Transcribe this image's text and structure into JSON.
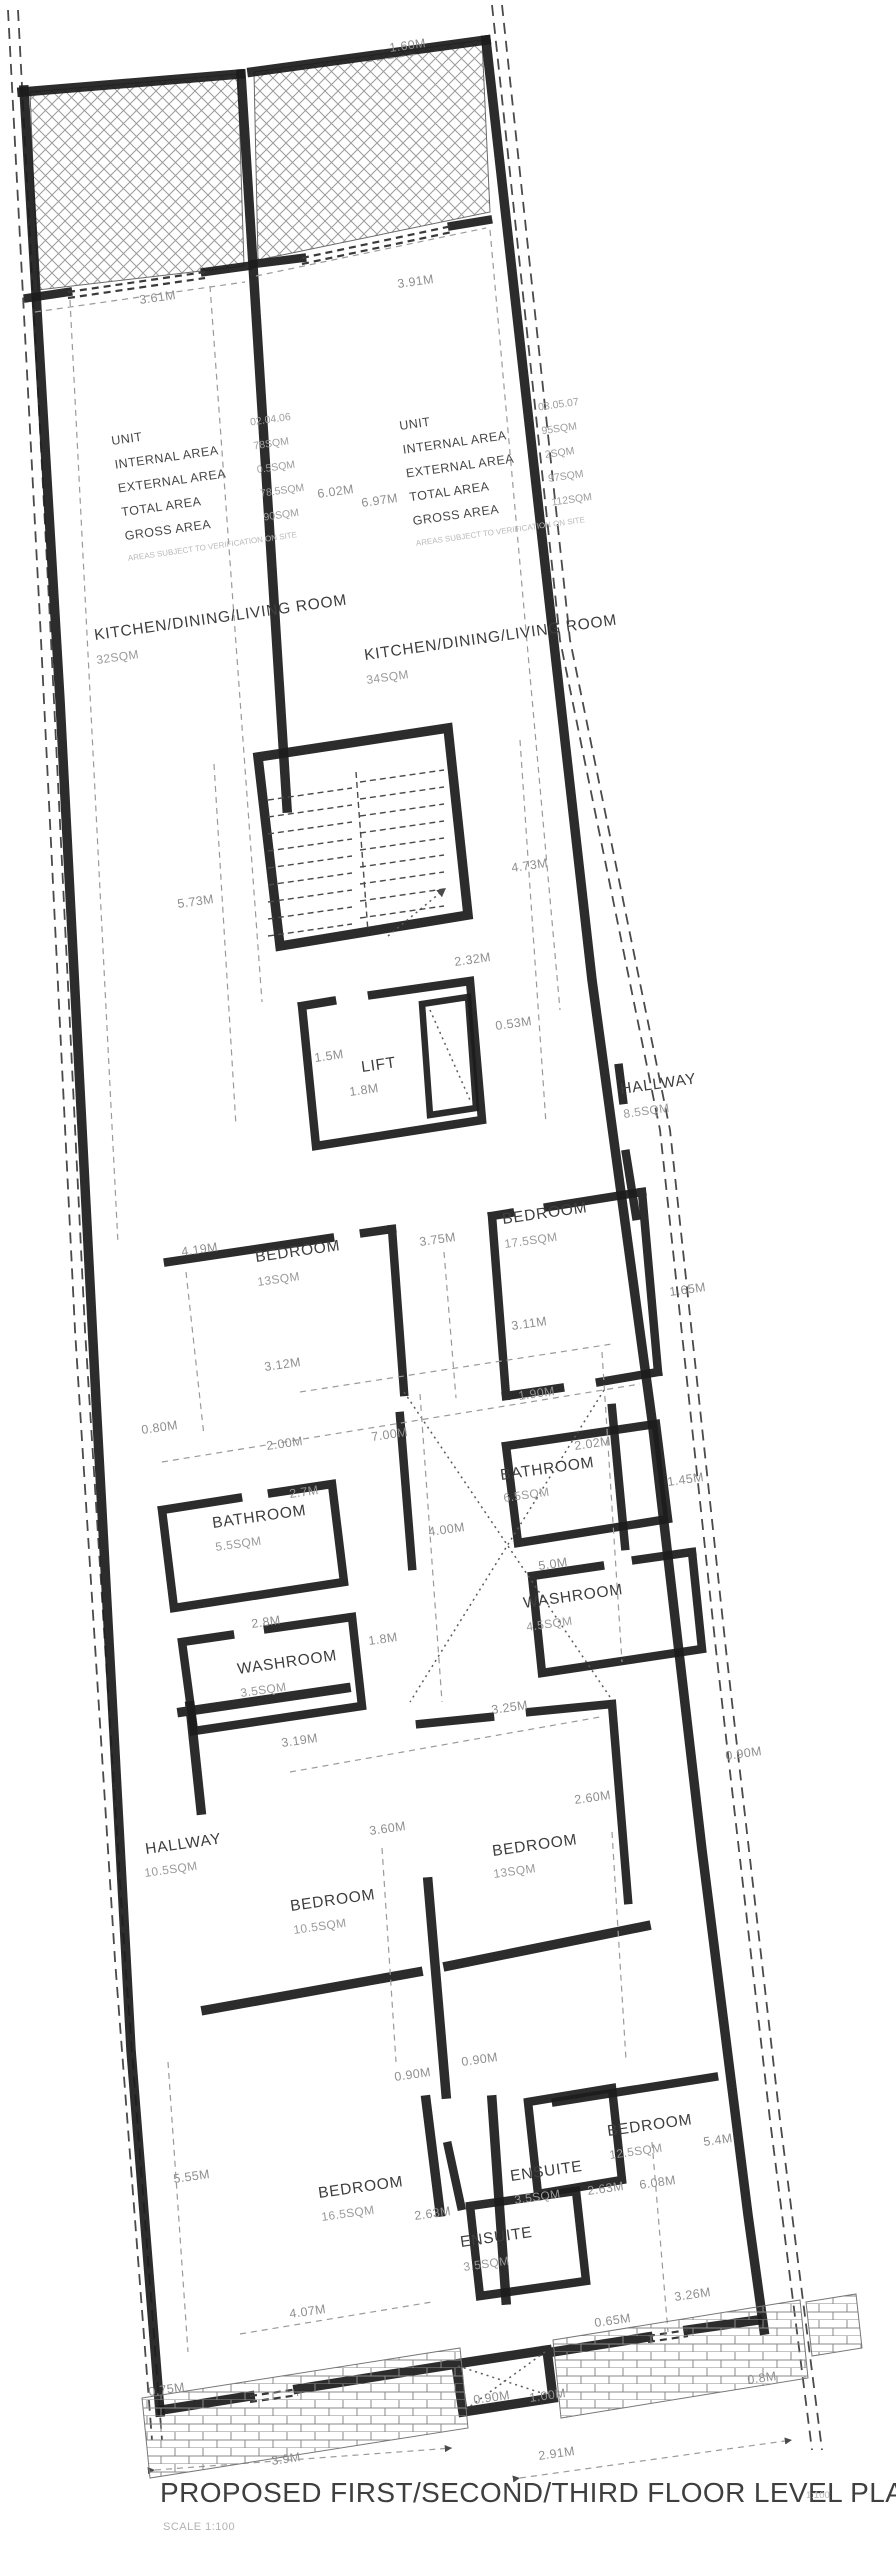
{
  "title": {
    "text": "PROPOSED FIRST/SECOND/THIRD FLOOR LEVEL PLAN",
    "scale_note": "SCALE 1:100",
    "sheet_note": "1:100"
  },
  "colors": {
    "ink": "#1c1c1c",
    "dim_text": "#8f8f8f",
    "room_text": "#3d3d3d",
    "paper": "#ffffff",
    "hatch": "#9b9b9b",
    "brick": "#8a8a8a"
  },
  "tables": {
    "left": {
      "lx": 112,
      "vx": 252,
      "y0": 445,
      "dy": 24,
      "fy": 562,
      "rows": [
        {
          "label": "UNIT",
          "value": "02.04.06"
        },
        {
          "label": "INTERNAL AREA",
          "value": "78SQM"
        },
        {
          "label": "EXTERNAL AREA",
          "value": "0.5SQM"
        },
        {
          "label": "TOTAL AREA",
          "value": "78.5SQM"
        },
        {
          "label": "GROSS AREA",
          "value": "90SQM"
        }
      ],
      "footnote": "AREAS SUBJECT TO VERIFICATION ON SITE"
    },
    "right": {
      "lx": 400,
      "vx": 540,
      "y0": 430,
      "dy": 24,
      "fy": 547,
      "rows": [
        {
          "label": "UNIT",
          "value": "03.05.07"
        },
        {
          "label": "INTERNAL AREA",
          "value": "95SQM"
        },
        {
          "label": "EXTERNAL AREA",
          "value": "2SQM"
        },
        {
          "label": "TOTAL AREA",
          "value": "97SQM"
        },
        {
          "label": "GROSS AREA",
          "value": "112SQM"
        }
      ],
      "footnote": "AREAS SUBJECT TO VERIFICATION ON SITE"
    }
  },
  "rooms": [
    {
      "n": "KITCHEN/DINING/LIVING ROOM",
      "a": "32SQM",
      "x": 95,
      "y": 640,
      "ax": 97,
      "ay": 664
    },
    {
      "n": "KITCHEN/DINING/LIVING ROOM",
      "a": "34SQM",
      "x": 365,
      "y": 660,
      "ax": 367,
      "ay": 684
    },
    {
      "n": "LIFT",
      "a": "",
      "x": 362,
      "y": 1072,
      "ax": 0,
      "ay": 0
    },
    {
      "n": "HALLWAY",
      "a": "8.5SQM",
      "x": 621,
      "y": 1094,
      "ax": 624,
      "ay": 1118
    },
    {
      "n": "BEDROOM",
      "a": "13SQM",
      "x": 256,
      "y": 1262,
      "ax": 258,
      "ay": 1286
    },
    {
      "n": "BEDROOM",
      "a": "17.5SQM",
      "x": 503,
      "y": 1224,
      "ax": 505,
      "ay": 1248
    },
    {
      "n": "BATHROOM",
      "a": "6.5SQM",
      "x": 501,
      "y": 1480,
      "ax": 504,
      "ay": 1502
    },
    {
      "n": "BATHROOM",
      "a": "5.5SQM",
      "x": 213,
      "y": 1528,
      "ax": 216,
      "ay": 1551
    },
    {
      "n": "WASHROOM",
      "a": "4.5SQM",
      "x": 524,
      "y": 1608,
      "ax": 527,
      "ay": 1631
    },
    {
      "n": "WASHROOM",
      "a": "3.5SQM",
      "x": 238,
      "y": 1674,
      "ax": 241,
      "ay": 1697
    },
    {
      "n": "HALLWAY",
      "a": "10.5SQM",
      "x": 146,
      "y": 1854,
      "ax": 145,
      "ay": 1877
    },
    {
      "n": "BEDROOM",
      "a": "13SQM",
      "x": 493,
      "y": 1856,
      "ax": 494,
      "ay": 1878
    },
    {
      "n": "BEDROOM",
      "a": "10.5SQM",
      "x": 291,
      "y": 1911,
      "ax": 294,
      "ay": 1934
    },
    {
      "n": "BEDROOM",
      "a": "16.5SQM",
      "x": 319,
      "y": 2198,
      "ax": 322,
      "ay": 2221
    },
    {
      "n": "ENSUITE",
      "a": "3.5SQM",
      "x": 511,
      "y": 2181,
      "ax": 515,
      "ay": 2204
    },
    {
      "n": "ENSUITE",
      "a": "3.5SQM",
      "x": 461,
      "y": 2247,
      "ax": 464,
      "ay": 2271
    },
    {
      "n": "BEDROOM",
      "a": "12.5SQM",
      "x": 608,
      "y": 2136,
      "ax": 610,
      "ay": 2159
    }
  ],
  "dims": [
    {
      "t": "1.60M",
      "x": 390,
      "y": 52
    },
    {
      "t": "3.61M",
      "x": 140,
      "y": 304
    },
    {
      "t": "3.91M",
      "x": 398,
      "y": 288
    },
    {
      "t": "6.02M",
      "x": 318,
      "y": 498
    },
    {
      "t": "6.97M",
      "x": 362,
      "y": 507
    },
    {
      "t": "5.73M",
      "x": 178,
      "y": 908
    },
    {
      "t": "4.73M",
      "x": 512,
      "y": 872
    },
    {
      "t": "2.32M",
      "x": 455,
      "y": 966
    },
    {
      "t": "0.53M",
      "x": 496,
      "y": 1030
    },
    {
      "t": "1.5M",
      "x": 315,
      "y": 1062
    },
    {
      "t": "1.8M",
      "x": 350,
      "y": 1096
    },
    {
      "t": "4.19M",
      "x": 182,
      "y": 1256
    },
    {
      "t": "3.75M",
      "x": 420,
      "y": 1246
    },
    {
      "t": "1.65M",
      "x": 670,
      "y": 1296
    },
    {
      "t": "3.11M",
      "x": 512,
      "y": 1330
    },
    {
      "t": "3.12M",
      "x": 265,
      "y": 1371
    },
    {
      "t": "1.90M",
      "x": 519,
      "y": 1400
    },
    {
      "t": "0.80M",
      "x": 142,
      "y": 1434
    },
    {
      "t": "2.00M",
      "x": 267,
      "y": 1450
    },
    {
      "t": "7.00M",
      "x": 372,
      "y": 1441
    },
    {
      "t": "2.02M",
      "x": 575,
      "y": 1450
    },
    {
      "t": "1.45M",
      "x": 668,
      "y": 1486
    },
    {
      "t": "2.7M",
      "x": 290,
      "y": 1498
    },
    {
      "t": "4.00M",
      "x": 429,
      "y": 1536
    },
    {
      "t": "5.0M",
      "x": 539,
      "y": 1570
    },
    {
      "t": "2.8M",
      "x": 252,
      "y": 1628
    },
    {
      "t": "1.8M",
      "x": 369,
      "y": 1645
    },
    {
      "t": "3.25M",
      "x": 492,
      "y": 1714
    },
    {
      "t": "3.19M",
      "x": 282,
      "y": 1747
    },
    {
      "t": "2.60M",
      "x": 575,
      "y": 1804
    },
    {
      "t": "0.90M",
      "x": 726,
      "y": 1760
    },
    {
      "t": "3.60M",
      "x": 370,
      "y": 1835
    },
    {
      "t": "0.90M",
      "x": 462,
      "y": 2066
    },
    {
      "t": "0.90M",
      "x": 395,
      "y": 2081
    },
    {
      "t": "5.55M",
      "x": 174,
      "y": 2183
    },
    {
      "t": "2.63M",
      "x": 588,
      "y": 2195
    },
    {
      "t": "2.63M",
      "x": 415,
      "y": 2220
    },
    {
      "t": "5.4M",
      "x": 704,
      "y": 2146
    },
    {
      "t": "6.08M",
      "x": 640,
      "y": 2189
    },
    {
      "t": "4.07M",
      "x": 290,
      "y": 2318
    },
    {
      "t": "0.65M",
      "x": 595,
      "y": 2327
    },
    {
      "t": "3.26M",
      "x": 675,
      "y": 2301
    },
    {
      "t": "0.8M",
      "x": 748,
      "y": 2384
    },
    {
      "t": "0.75M",
      "x": 149,
      "y": 2396
    },
    {
      "t": "0.90M",
      "x": 474,
      "y": 2404
    },
    {
      "t": "1.00M",
      "x": 530,
      "y": 2402
    },
    {
      "t": "3.9M",
      "x": 272,
      "y": 2465
    },
    {
      "t": "2.91M",
      "x": 539,
      "y": 2460
    }
  ]
}
